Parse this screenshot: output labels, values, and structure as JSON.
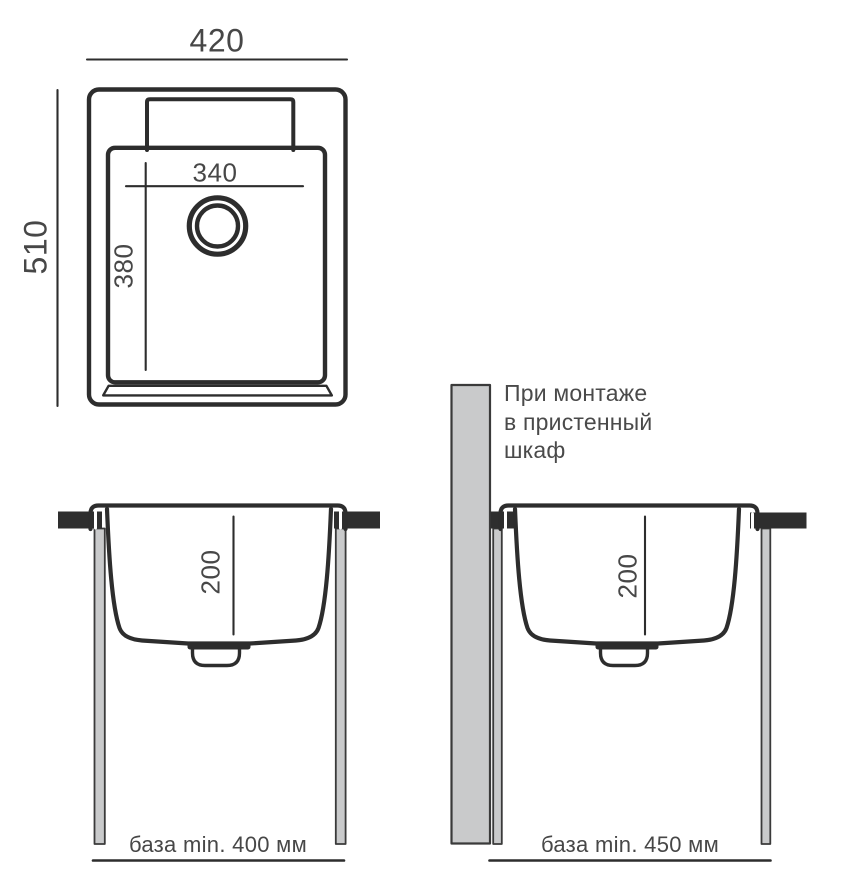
{
  "top_view": {
    "width": "420",
    "height": "510",
    "bowl_width": "340",
    "bowl_height": "380"
  },
  "section_left": {
    "depth": "200",
    "base": "база min. 400 мм"
  },
  "section_right": {
    "depth": "200",
    "base": "база min. 450 мм",
    "note_lines": [
      "При монтаже",
      "в пристенный",
      "шкаф"
    ]
  },
  "colors": {
    "line": "#2d2d2d",
    "text": "#474747",
    "panel_fill": "#c9cacb",
    "countertop_fill": "#2e2e2e"
  }
}
